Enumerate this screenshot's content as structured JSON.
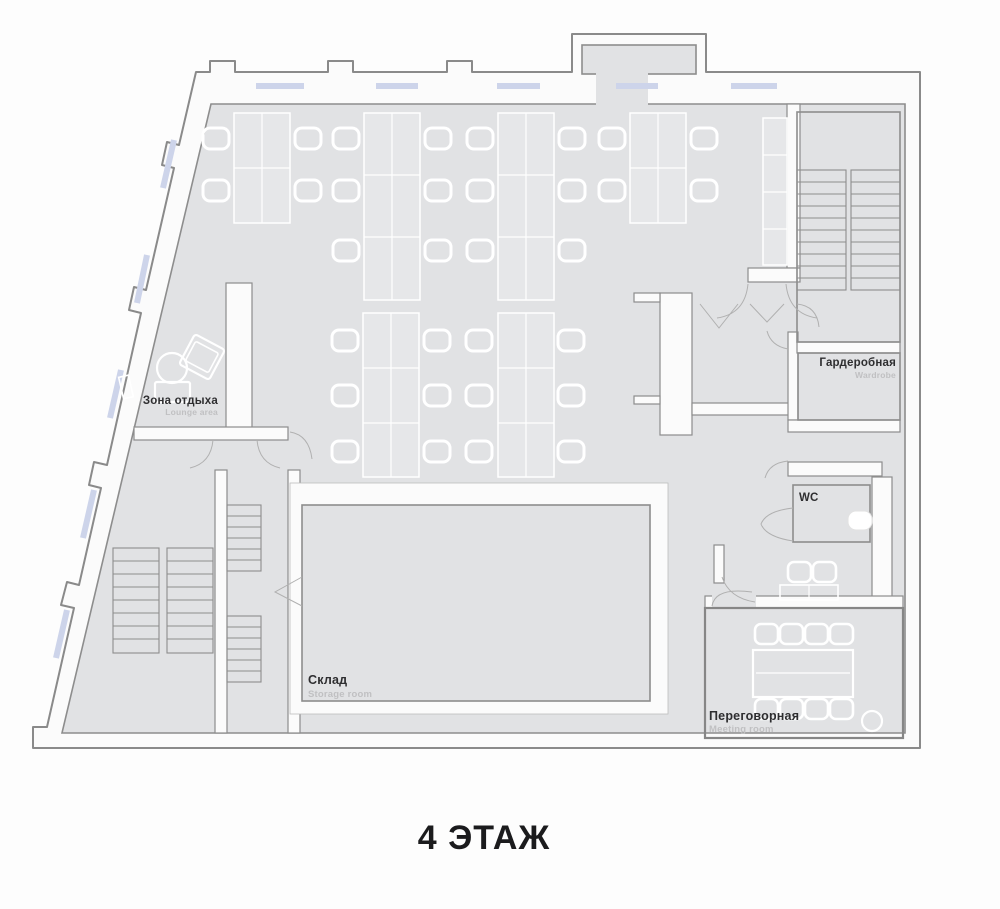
{
  "title": {
    "text": "4 ЭТАЖ"
  },
  "rooms": {
    "lounge": {
      "ru": "Зона отдыха",
      "en": "Lounge area"
    },
    "wardrobe": {
      "ru": "Гардеробная",
      "en": "Wardrobe"
    },
    "wc": {
      "ru": "WC"
    },
    "storage": {
      "ru": "Склад",
      "en": "Storage room"
    },
    "meeting": {
      "ru": "Переговорная",
      "en": "Meeting room"
    }
  },
  "features": {
    "staircases": 2,
    "desk_clusters": 7,
    "meeting_seats": 8
  },
  "colors": {
    "page_background": "#fdfdfd",
    "floor": "#e1e2e4",
    "wall_fill": "#fbfbfb",
    "wall_stroke": "#8a8a8a",
    "furniture": "#ffffff",
    "window": "#cdd4ea",
    "label_dark": "#2e2e30",
    "label_light": "#c0c0c2"
  }
}
